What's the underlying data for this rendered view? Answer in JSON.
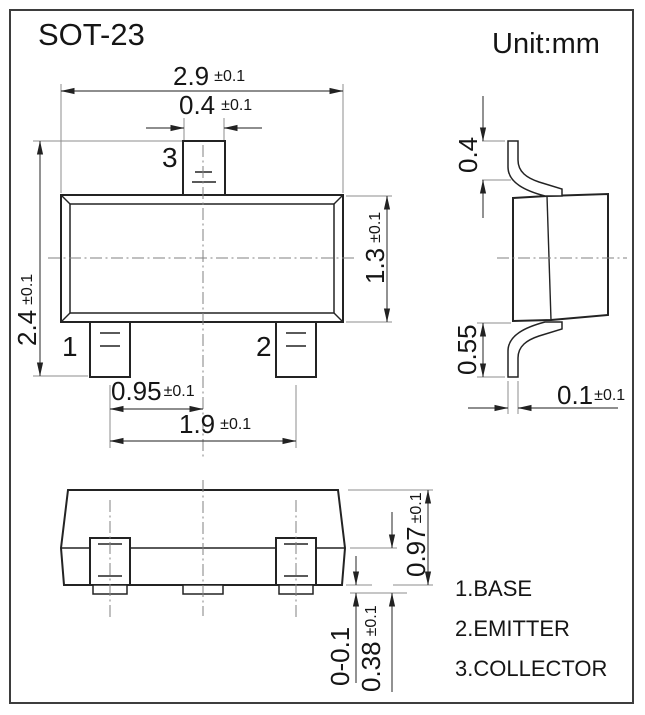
{
  "title": "SOT-23",
  "unit_label": "Unit:mm",
  "pins": {
    "p1": "1",
    "p2": "2",
    "p3": "3"
  },
  "dims": {
    "body_width": {
      "v": "2.9",
      "t": "±0.1"
    },
    "lead_width": {
      "v": "0.4",
      "t": "±0.1"
    },
    "overall_depth": {
      "v": "2.4",
      "t": "±0.1"
    },
    "body_depth": {
      "v": "1.3",
      "t": "±0.1"
    },
    "lead_pitch": {
      "v": "0.95",
      "t": "±0.1"
    },
    "lead_span": {
      "v": "1.9",
      "t": "±0.1"
    },
    "top_lead_height": {
      "v": "0.4",
      "t": ""
    },
    "bottom_lead_height": {
      "v": "0.55",
      "t": ""
    },
    "lead_thickness": {
      "v": "0.1",
      "t": "±0.1"
    },
    "body_height": {
      "v": "0.97",
      "t": "±0.1"
    },
    "lead_foot_height": {
      "v": "0.38",
      "t": "±0.1"
    },
    "standoff": {
      "v": "0-0.1",
      "t": ""
    }
  },
  "legend": [
    {
      "label": "1.BASE"
    },
    {
      "label": "2.EMITTER"
    },
    {
      "label": "3.COLLECTOR"
    }
  ],
  "colors": {
    "outline": "#232323",
    "dimension_line": "#4a4a4a",
    "extension_line": "#8d8d8d",
    "centerline": "#828282",
    "text": "#151515",
    "background": "#ffffff",
    "border": "#3d3d3d"
  }
}
